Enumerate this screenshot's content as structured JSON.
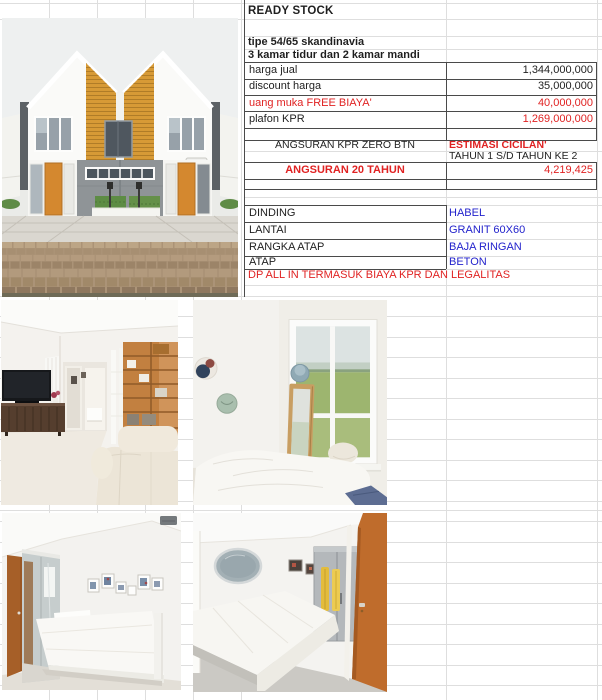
{
  "sheet_title": "READY STOCK",
  "listing": {
    "type_line": "tipe 54/65 skandinavia",
    "rooms_line": "3 kamar tidur dan 2 kamar mandi",
    "pricing": [
      {
        "label": "harga jual",
        "value": "1,344,000,000"
      },
      {
        "label": "discount harga",
        "value": "35,000,000"
      },
      {
        "label": "uang muka FREE BIAYA'",
        "value": "40,000,000"
      },
      {
        "label": "plafon KPR",
        "value": "1,269,000,000"
      }
    ],
    "installment": {
      "program": "ANGSURAN KPR ZERO BTN",
      "estimate_title": "ESTIMASI CICILAN'",
      "period": "TAHUN 1 S/D TAHUN KE 2",
      "tenor": "ANGSURAN 20 TAHUN",
      "monthly": "4,219,425"
    },
    "specs": [
      {
        "label": "DINDING",
        "value": "HABEL"
      },
      {
        "label": "LANTAI",
        "value": "GRANIT 60X60"
      },
      {
        "label": "RANGKA ATAP",
        "value": "BAJA RINGAN"
      },
      {
        "label": "ATAP",
        "value": "BETON"
      }
    ],
    "note": "DP ALL IN TERMASUK BIAYA KPR DAN LEGALITAS"
  },
  "photos": [
    {
      "name": "house-exterior-front"
    },
    {
      "name": "living-room"
    },
    {
      "name": "bedroom-window-view"
    },
    {
      "name": "bedroom-mirror-wardrobe"
    },
    {
      "name": "bedroom-wardrobe-towels"
    }
  ],
  "colors": {
    "red_text": "#e02222",
    "blue_text": "#2323cc",
    "black_text": "#1f1f1f",
    "grid_line": "#dedede",
    "cell_border": "#4a4a4a",
    "facade_yellow": "#d79a36",
    "door_orange": "#c9702e"
  }
}
